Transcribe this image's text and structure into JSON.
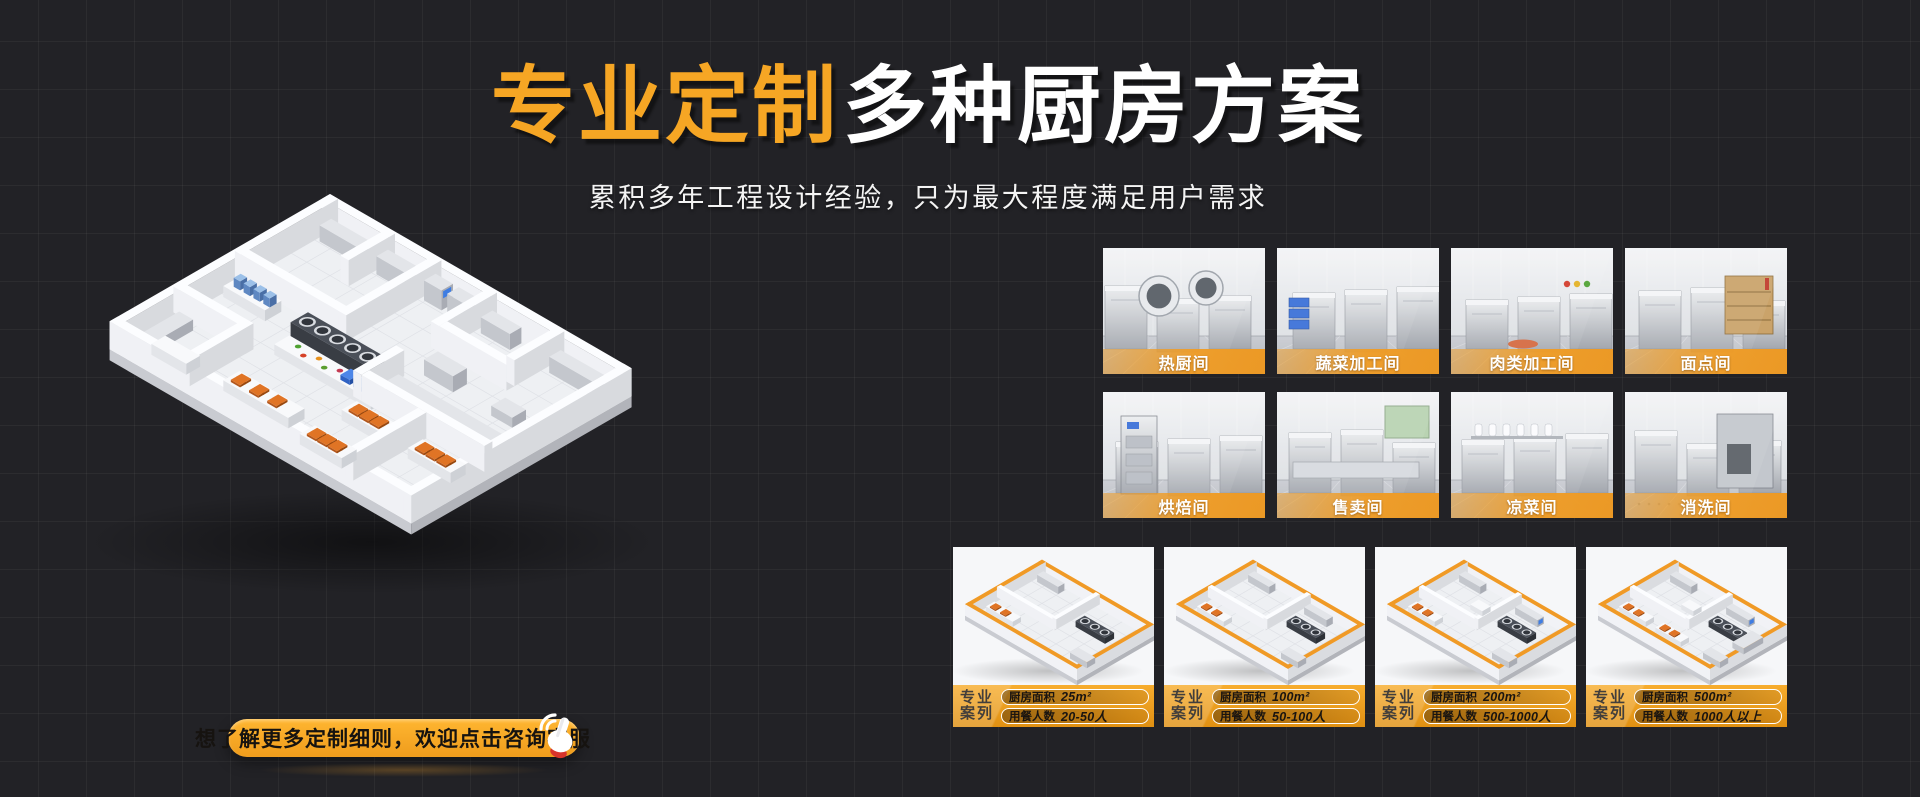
{
  "hero": {
    "title_highlight": "专业定制",
    "title_rest": "多种厨房方案",
    "subtitle": "累积多年工程设计经验，只为最大程度满足用户需求"
  },
  "cta": {
    "label": "想了解更多定制细则，欢迎点击咨询客服",
    "icon": "click-hand-icon"
  },
  "rooms": [
    {
      "label": "热厨间"
    },
    {
      "label": "蔬菜加工间"
    },
    {
      "label": "肉类加工间"
    },
    {
      "label": "面点间"
    },
    {
      "label": "烘焙间"
    },
    {
      "label": "售卖间"
    },
    {
      "label": "凉菜间"
    },
    {
      "label": "消洗间"
    }
  ],
  "cases": [
    {
      "tag_line1": "专业",
      "tag_line2": "案列",
      "area_label": "厨房面积",
      "area_value": "25m²",
      "diners_label": "用餐人数",
      "diners_value": "20-50人"
    },
    {
      "tag_line1": "专业",
      "tag_line2": "案列",
      "area_label": "厨房面积",
      "area_value": "100m²",
      "diners_label": "用餐人数",
      "diners_value": "50-100人"
    },
    {
      "tag_line1": "专业",
      "tag_line2": "案列",
      "area_label": "厨房面积",
      "area_value": "200m²",
      "diners_label": "用餐人数",
      "diners_value": "500-1000人"
    },
    {
      "tag_line1": "专业",
      "tag_line2": "案列",
      "area_label": "厨房面积",
      "area_value": "500m²",
      "diners_label": "用餐人数",
      "diners_value": "1000人以上"
    }
  ],
  "colors": {
    "accent_orange": "#F6A624",
    "background": "#222226",
    "title_white": "#FFFFFF",
    "label_bar_orange": "#F09C24"
  }
}
